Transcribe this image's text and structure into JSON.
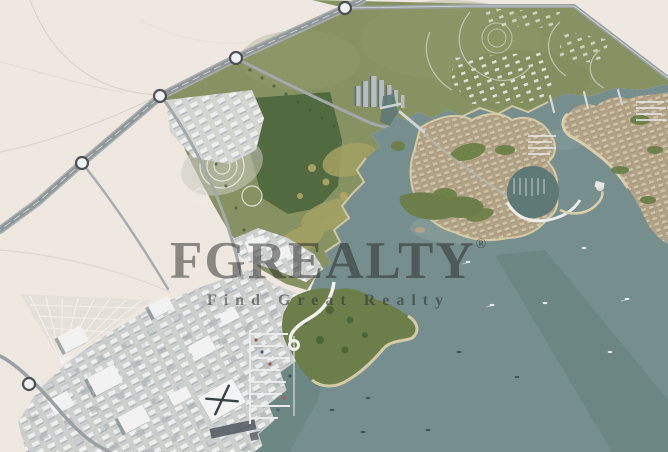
{
  "watermark": {
    "logo": "FGREALTY",
    "registered": "®",
    "tagline": "Find Great Realty",
    "color": "#2e2e2e"
  },
  "palette": {
    "desert": "#efe9e2",
    "desert_line": "#ddd5ca",
    "water": "#75908e",
    "water_dark": "#5d7977",
    "mainland_green": "#87935f",
    "park_green": "#4f6a3d",
    "headland_green": "#6b8048",
    "olive": "#a6a360",
    "sand": "#ddd0a7",
    "tan_island": "#b3a283",
    "road": "#8f9799",
    "downtown_ground": "#cfd1cf",
    "building_white": "#f2f3f2",
    "tower_gray": "#b7bfc1",
    "dock": "#eceeee",
    "marker_fill": "#f6f8f8",
    "marker_ring": "#454d52",
    "boat": "#f2f4f4",
    "boat_dark": "#3e4c4e"
  },
  "markers": {
    "radius": 6,
    "roundabouts": [
      {
        "x": 345,
        "y": 8
      },
      {
        "x": 236,
        "y": 58
      },
      {
        "x": 160,
        "y": 96
      },
      {
        "x": 82,
        "y": 163
      },
      {
        "x": 29,
        "y": 384
      }
    ]
  },
  "boats": [
    {
      "x": 468,
      "y": 262,
      "dark": false,
      "wake": true
    },
    {
      "x": 492,
      "y": 305,
      "dark": false,
      "wake": true
    },
    {
      "x": 584,
      "y": 248,
      "dark": false,
      "wake": false
    },
    {
      "x": 627,
      "y": 299,
      "dark": false,
      "wake": true
    },
    {
      "x": 545,
      "y": 303,
      "dark": false,
      "wake": false
    },
    {
      "x": 610,
      "y": 352,
      "dark": false,
      "wake": false
    },
    {
      "x": 459,
      "y": 352,
      "dark": true,
      "wake": false
    },
    {
      "x": 517,
      "y": 377,
      "dark": true,
      "wake": false
    },
    {
      "x": 368,
      "y": 398,
      "dark": true,
      "wake": false
    },
    {
      "x": 332,
      "y": 410,
      "dark": true,
      "wake": false
    },
    {
      "x": 363,
      "y": 432,
      "dark": true,
      "wake": false
    },
    {
      "x": 428,
      "y": 430,
      "dark": true,
      "wake": false
    }
  ]
}
